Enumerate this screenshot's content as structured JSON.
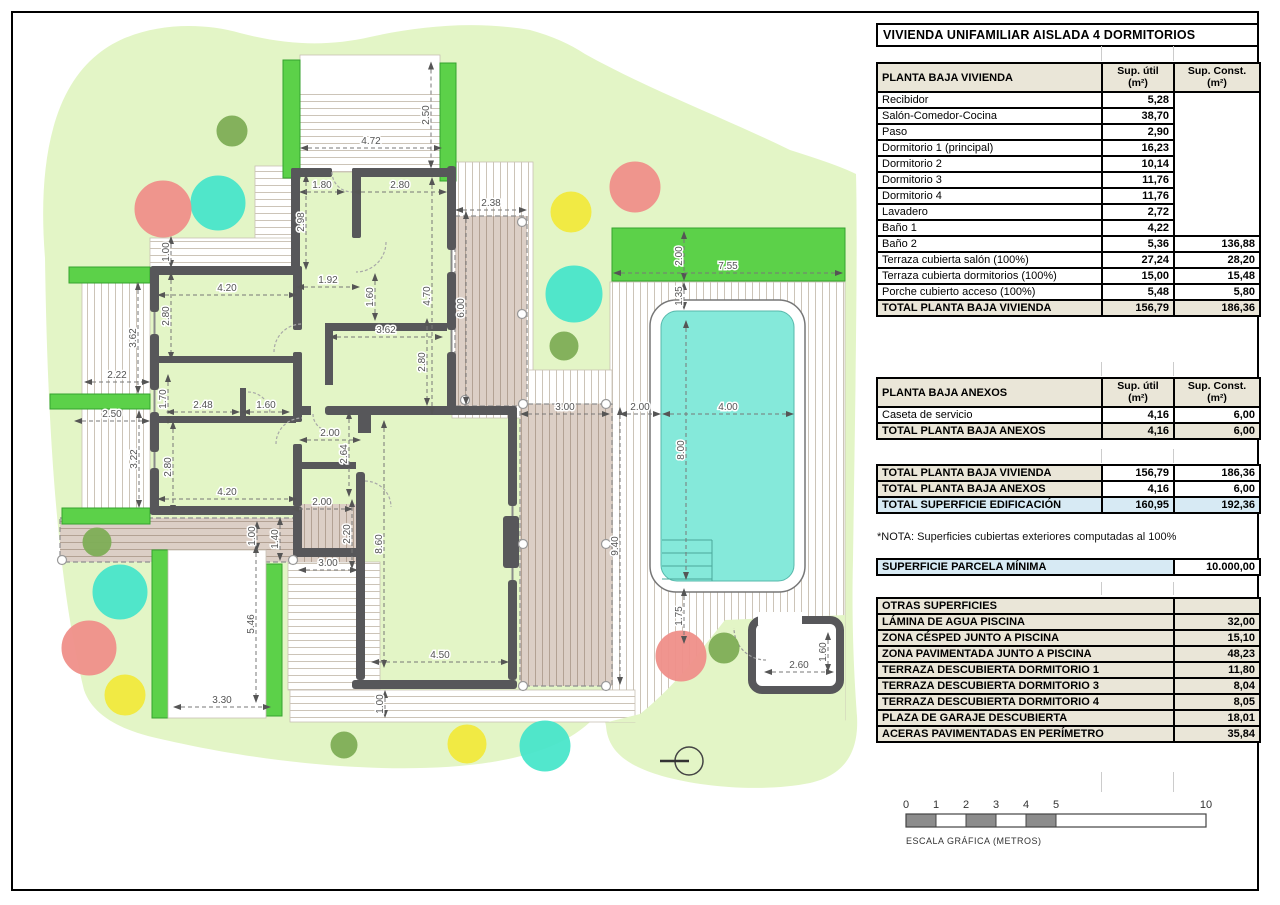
{
  "sheet": {
    "title": "VIVIENDA UNIFAMILIAR AISLADA 4 DORMITORIOS"
  },
  "tables": {
    "shared": {
      "col_util": "Sup. útil",
      "col_const": "Sup. Const.",
      "col_unit": "(m²)"
    },
    "vivienda": {
      "title": "PLANTA BAJA VIVIENDA",
      "rows": [
        [
          "Recibidor",
          "5,28",
          ""
        ],
        [
          "Salón-Comedor-Cocina",
          "38,70",
          ""
        ],
        [
          "Paso",
          "2,90",
          ""
        ],
        [
          "Dormitorio 1 (principal)",
          "16,23",
          ""
        ],
        [
          "Dormitorio 2",
          "10,14",
          ""
        ],
        [
          "Dormitorio 3",
          "11,76",
          ""
        ],
        [
          "Dormitorio 4",
          "11,76",
          ""
        ],
        [
          "Lavadero",
          "2,72",
          ""
        ],
        [
          "Baño 1",
          "4,22",
          ""
        ],
        [
          "Baño 2",
          "5,36",
          "136,88"
        ],
        [
          "Terraza cubierta salón (100%)",
          "27,24",
          "28,20"
        ],
        [
          "Terraza cubierta dormitorios (100%)",
          "15,00",
          "15,48"
        ],
        [
          "Porche cubierto acceso (100%)",
          "5,48",
          "5,80"
        ]
      ],
      "total": [
        "TOTAL PLANTA BAJA VIVIENDA",
        "156,79",
        "186,36"
      ]
    },
    "anexos": {
      "title": "PLANTA BAJA ANEXOS",
      "rows": [
        [
          "Caseta de servicio",
          "4,16",
          "6,00"
        ]
      ],
      "total": [
        "TOTAL PLANTA BAJA ANEXOS",
        "4,16",
        "6,00"
      ]
    },
    "resumen": {
      "rows": [
        [
          "TOTAL PLANTA BAJA VIVIENDA",
          "156,79",
          "186,36"
        ],
        [
          "TOTAL PLANTA BAJA ANEXOS",
          "4,16",
          "6,00"
        ]
      ],
      "total": [
        "TOTAL SUPERFICIE EDIFICACIÓN",
        "160,95",
        "192,36"
      ]
    },
    "nota": "*NOTA: Superficies cubiertas exteriores computadas al 100%",
    "parcela": {
      "label": "SUPERFICIE PARCELA MÍNIMA",
      "value": "10.000,00"
    },
    "otras": {
      "title": "OTRAS SUPERFICIES",
      "rows": [
        [
          "LÁMINA DE AGUA PISCINA",
          "32,00"
        ],
        [
          "ZONA CÉSPED JUNTO A PISCINA",
          "15,10"
        ],
        [
          "ZONA PAVIMENTADA JUNTO A PISCINA",
          "48,23"
        ],
        [
          "TERRAZA DESCUBIERTA DORMITORIO 1",
          "11,80"
        ],
        [
          "TERRAZA DESCUBIERTA DORMITORIO 3",
          "8,04"
        ],
        [
          "TERRAZA DESCUBIERTA DORMITORIO 4",
          "8,05"
        ],
        [
          "PLAZA DE GARAJE DESCUBIERTA",
          "18,01"
        ],
        [
          "ACERAS PAVIMENTADAS EN PERÍMETRO",
          "35,84"
        ]
      ]
    }
  },
  "scalebar": {
    "ticks": [
      {
        "label": "0",
        "m": 0
      },
      {
        "label": "1",
        "m": 1
      },
      {
        "label": "2",
        "m": 2
      },
      {
        "label": "3",
        "m": 3
      },
      {
        "label": "4",
        "m": 4
      },
      {
        "label": "5",
        "m": 5
      },
      {
        "label": "10",
        "m": 10
      }
    ],
    "filled_segments": [
      [
        0,
        1
      ],
      [
        2,
        3
      ],
      [
        4,
        5
      ]
    ],
    "caption": "ESCALA GRÁFICA (METROS)"
  },
  "plan": {
    "colors": {
      "garden": "#e3f5c6",
      "hedge": "#5cd149",
      "hedge_edge": "#35a22e",
      "pool_water": "#85e9da",
      "wall": "#57575a",
      "tree_red": "#f0908a",
      "tree_teal": "#49e6cb",
      "tree_green": "#7fae57",
      "tree_yellow": "#f2ea3e"
    },
    "dimensions": [
      {
        "v": "4.72",
        "o": "h",
        "x": 371,
        "y": 148,
        "l": 140
      },
      {
        "v": "2.50",
        "o": "v",
        "x": 431,
        "y": 115,
        "l": 105
      },
      {
        "v": "1.80",
        "o": "h",
        "x": 322,
        "y": 192,
        "l": 44
      },
      {
        "v": "2.80",
        "o": "h",
        "x": 400,
        "y": 192,
        "l": 92
      },
      {
        "v": "2.38",
        "o": "h",
        "x": 491,
        "y": 210,
        "l": 70
      },
      {
        "v": "2.98",
        "o": "v",
        "x": 306,
        "y": 222,
        "l": 94
      },
      {
        "v": "4.70",
        "o": "v",
        "x": 432,
        "y": 296,
        "l": 236
      },
      {
        "v": "1.00",
        "o": "v",
        "x": 171,
        "y": 252,
        "l": 30
      },
      {
        "v": "6.00",
        "o": "v",
        "x": 466,
        "y": 308,
        "l": 192
      },
      {
        "v": "2.00",
        "o": "v",
        "x": 684,
        "y": 256,
        "l": 48
      },
      {
        "v": "7.55",
        "o": "h",
        "x": 728,
        "y": 273,
        "l": 228
      },
      {
        "v": "1.35",
        "o": "v",
        "x": 684,
        "y": 296,
        "l": 26
      },
      {
        "v": "4.20",
        "o": "h",
        "x": 227,
        "y": 295,
        "l": 138
      },
      {
        "v": "1.92",
        "o": "h",
        "x": 328,
        "y": 287,
        "l": 62
      },
      {
        "v": "1.60",
        "o": "v",
        "x": 375,
        "y": 297,
        "l": 46
      },
      {
        "v": "3.62",
        "o": "h",
        "x": 386,
        "y": 337,
        "l": 112
      },
      {
        "v": "2.80",
        "o": "v",
        "x": 427,
        "y": 362,
        "l": 86
      },
      {
        "v": "3.62",
        "o": "v",
        "x": 138,
        "y": 338,
        "l": 110
      },
      {
        "v": "2.80",
        "o": "v",
        "x": 171,
        "y": 316,
        "l": 86
      },
      {
        "v": "2.22",
        "o": "h",
        "x": 117,
        "y": 382,
        "l": 64
      },
      {
        "v": "1.70",
        "o": "v",
        "x": 168,
        "y": 399,
        "l": 48
      },
      {
        "v": "2.48",
        "o": "h",
        "x": 203,
        "y": 412,
        "l": 72
      },
      {
        "v": "1.60",
        "o": "h",
        "x": 266,
        "y": 412,
        "l": 46
      },
      {
        "v": "2.50",
        "o": "h",
        "x": 112,
        "y": 421,
        "l": 74
      },
      {
        "v": "3.22",
        "o": "v",
        "x": 139,
        "y": 459,
        "l": 96
      },
      {
        "v": "2.80",
        "o": "v",
        "x": 173,
        "y": 467,
        "l": 90
      },
      {
        "v": "2.00",
        "o": "h",
        "x": 330,
        "y": 440,
        "l": 60
      },
      {
        "v": "2.64",
        "o": "v",
        "x": 349,
        "y": 454,
        "l": 84
      },
      {
        "v": "3.00",
        "o": "h",
        "x": 565,
        "y": 414,
        "l": 88
      },
      {
        "v": "2.00",
        "o": "h",
        "x": 640,
        "y": 414,
        "l": 40
      },
      {
        "v": "4.00",
        "o": "h",
        "x": 728,
        "y": 414,
        "l": 130
      },
      {
        "v": "8.00",
        "o": "v",
        "x": 686,
        "y": 450,
        "l": 258
      },
      {
        "v": "4.20",
        "o": "h",
        "x": 227,
        "y": 499,
        "l": 138
      },
      {
        "v": "2.00",
        "o": "h",
        "x": 322,
        "y": 509,
        "l": 60
      },
      {
        "v": "2.20",
        "o": "v",
        "x": 352,
        "y": 534,
        "l": 68
      },
      {
        "v": "1.40",
        "o": "v",
        "x": 280,
        "y": 539,
        "l": 42
      },
      {
        "v": "1.00",
        "o": "v",
        "x": 257,
        "y": 536,
        "l": 28
      },
      {
        "v": "3.00",
        "o": "h",
        "x": 328,
        "y": 570,
        "l": 58
      },
      {
        "v": "8.60",
        "o": "v",
        "x": 384,
        "y": 544,
        "l": 246
      },
      {
        "v": "9.40",
        "o": "v",
        "x": 620,
        "y": 546,
        "l": 276
      },
      {
        "v": "5.46",
        "o": "v",
        "x": 256,
        "y": 624,
        "l": 156
      },
      {
        "v": "1.75",
        "o": "v",
        "x": 684,
        "y": 616,
        "l": 54
      },
      {
        "v": "4.50",
        "o": "h",
        "x": 440,
        "y": 662,
        "l": 136
      },
      {
        "v": "3.30",
        "o": "h",
        "x": 222,
        "y": 707,
        "l": 96
      },
      {
        "v": "1.00",
        "o": "v",
        "x": 385,
        "y": 704,
        "l": 26
      },
      {
        "v": "2.60",
        "o": "h",
        "x": 799,
        "y": 672,
        "l": 68
      },
      {
        "v": "1.60",
        "o": "v",
        "x": 828,
        "y": 652,
        "l": 38
      }
    ],
    "trees": [
      {
        "c": "tree_green",
        "x": 232,
        "y": 131,
        "s": 15
      },
      {
        "c": "tree_teal",
        "x": 218,
        "y": 203,
        "s": 27
      },
      {
        "c": "tree_red",
        "x": 163,
        "y": 209,
        "s": 28
      },
      {
        "c": "tree_yellow",
        "x": 571,
        "y": 212,
        "s": 20
      },
      {
        "c": "tree_red",
        "x": 635,
        "y": 187,
        "s": 25
      },
      {
        "c": "tree_teal",
        "x": 574,
        "y": 294,
        "s": 28
      },
      {
        "c": "tree_green",
        "x": 564,
        "y": 346,
        "s": 14
      },
      {
        "c": "tree_green",
        "x": 97,
        "y": 542,
        "s": 14
      },
      {
        "c": "tree_teal",
        "x": 120,
        "y": 592,
        "s": 27
      },
      {
        "c": "tree_red",
        "x": 89,
        "y": 648,
        "s": 27
      },
      {
        "c": "tree_yellow",
        "x": 125,
        "y": 695,
        "s": 20
      },
      {
        "c": "tree_green",
        "x": 344,
        "y": 745,
        "s": 13
      },
      {
        "c": "tree_yellow",
        "x": 467,
        "y": 744,
        "s": 19
      },
      {
        "c": "tree_teal",
        "x": 545,
        "y": 746,
        "s": 25
      },
      {
        "c": "tree_red",
        "x": 681,
        "y": 656,
        "s": 25
      },
      {
        "c": "tree_green",
        "x": 724,
        "y": 648,
        "s": 15
      }
    ]
  }
}
